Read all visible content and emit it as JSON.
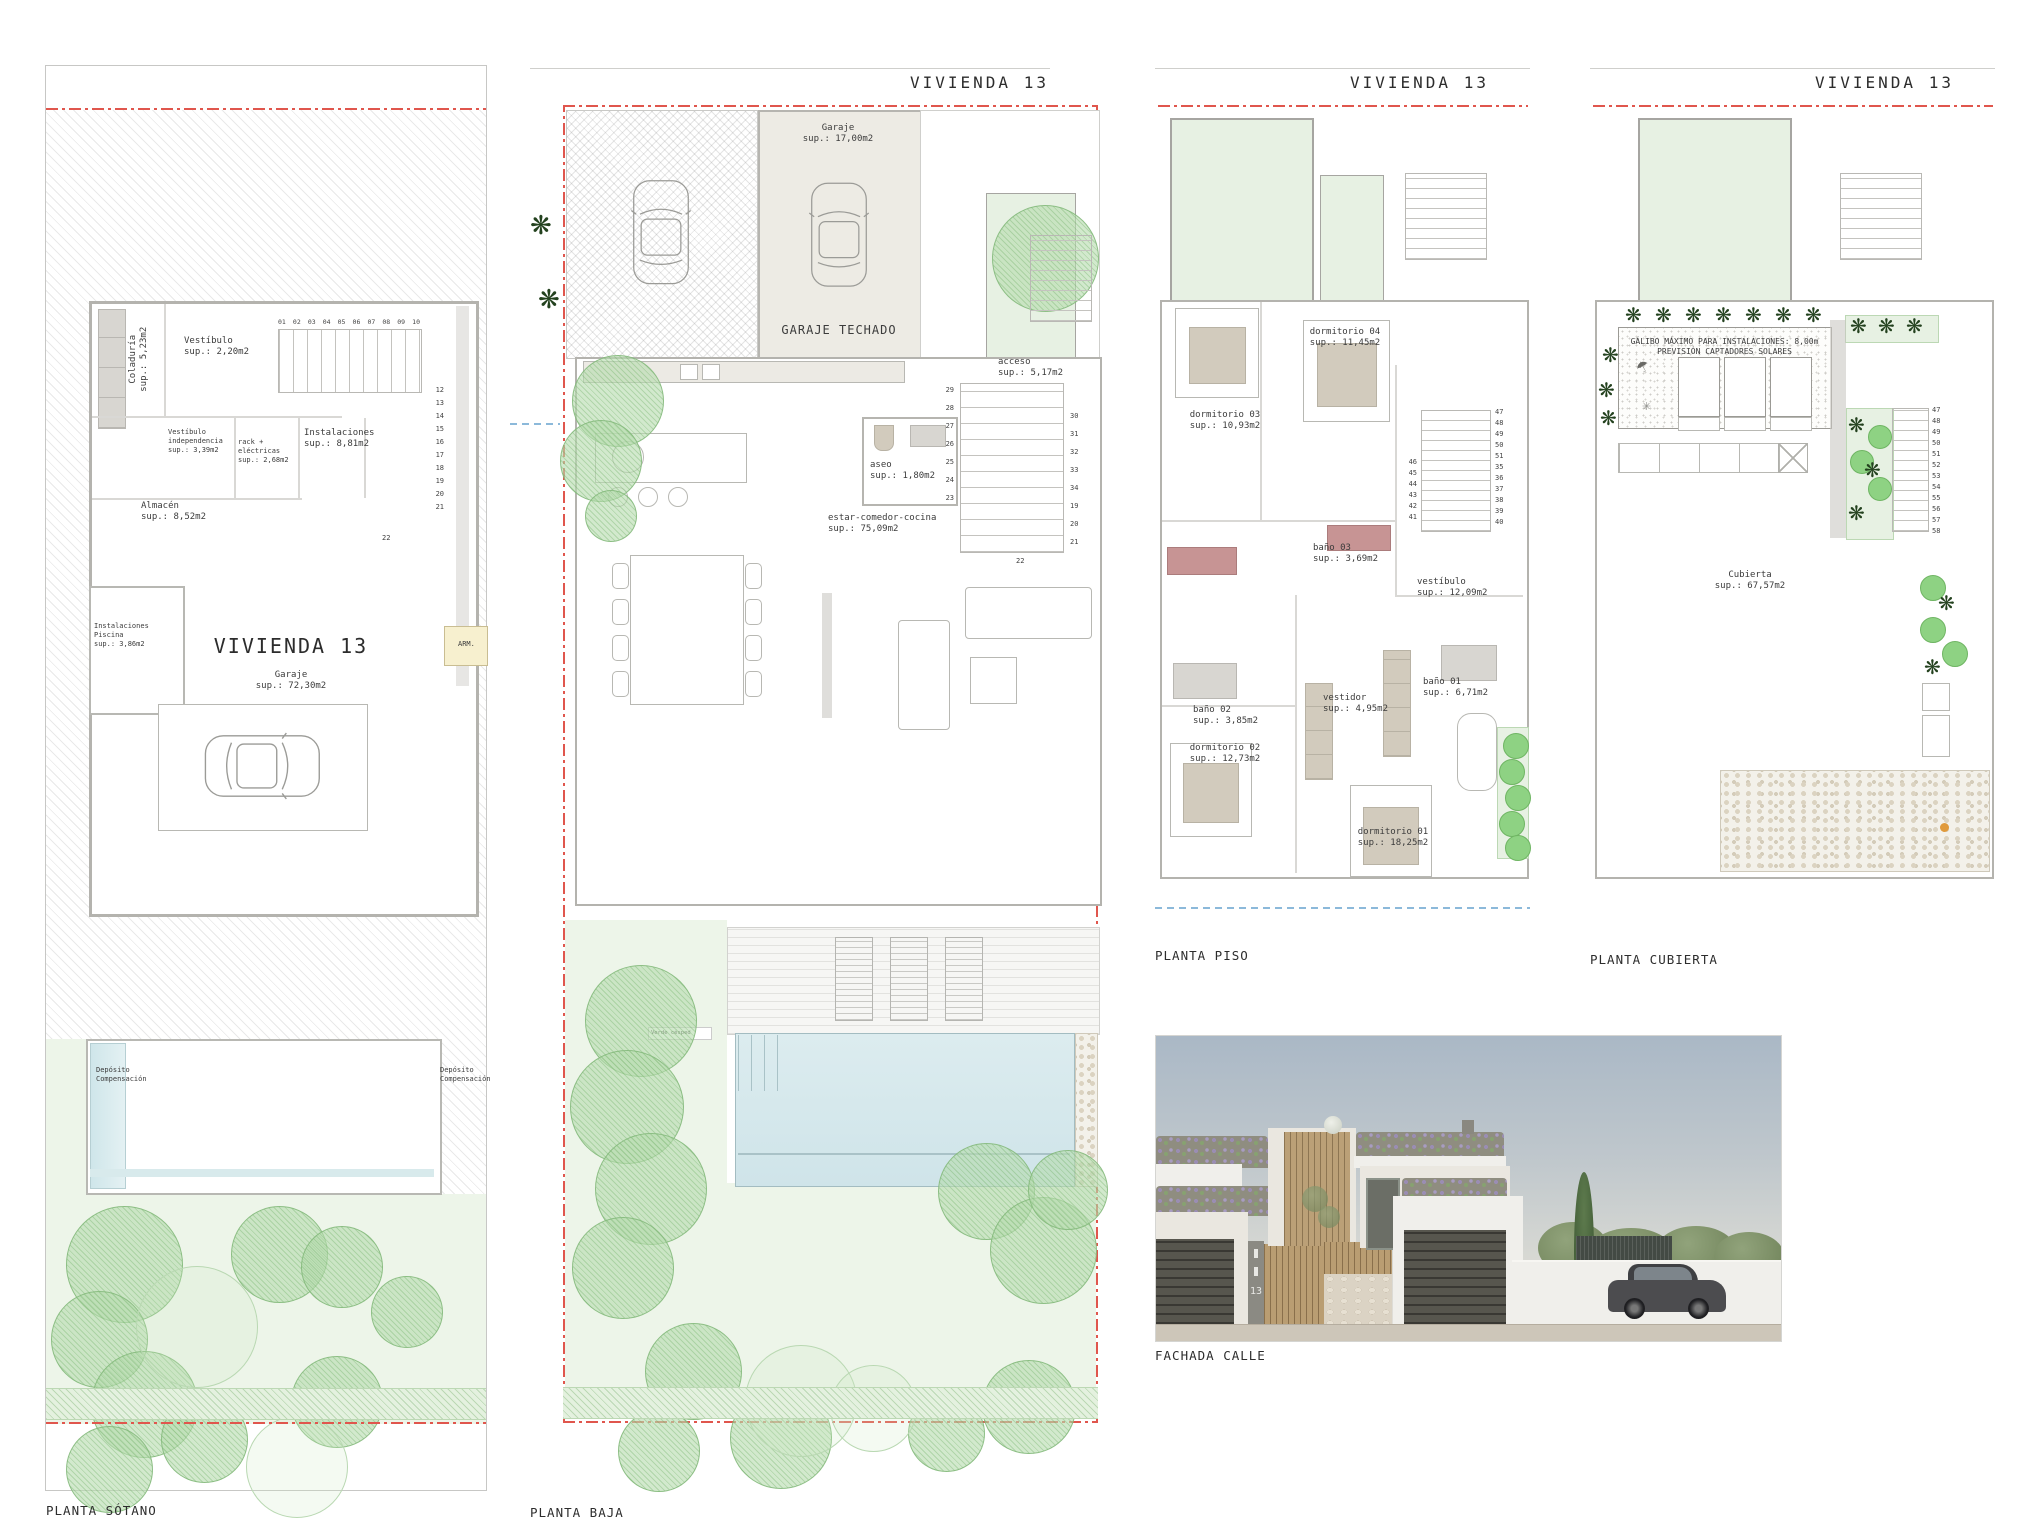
{
  "header": {
    "vivienda": "VIVIENDA 13"
  },
  "captions": {
    "sotano": "PLANTA SÓTANO",
    "baja": "PLANTA BAJA",
    "piso": "PLANTA PISO",
    "cubierta": "PLANTA CUBIERTA",
    "fachada": "FACHADA CALLE"
  },
  "sotano": {
    "coladuria": "Coladuría\nsup.: 5,23m2",
    "vestibulo": "Vestíbulo\nsup.: 2,20m2",
    "vestibulo_indep": "Vestíbulo\nindependencia\nsup.: 3,39m2",
    "rack": "rack + eléctricas\nsup.: 2,68m2",
    "instalaciones": "Instalaciones\nsup.: 8,81m2",
    "almacen": "Almacén\nsup.: 8,52m2",
    "inst_piscina": "Instalaciones Piscina\nsup.: 3,86m2",
    "vivienda": "VIVIENDA 13",
    "garaje": "Garaje\nsup.: 72,30m2",
    "armario": "ARM.",
    "deposito_izq": "Depósito\nCompensación",
    "deposito_der": "Depósito\nCompensación",
    "stairs_top": [
      "01",
      "02",
      "03",
      "04",
      "05",
      "06",
      "07",
      "08",
      "09",
      "10"
    ],
    "stairs_side": [
      "12",
      "13",
      "14",
      "15",
      "16",
      "17",
      "18",
      "19",
      "20",
      "21"
    ],
    "stair_22": "22"
  },
  "baja": {
    "garaje": "Garaje\nsup.: 17,00m2",
    "garaje_techado": "GARAJE TECHADO",
    "acceso": "acceso\nsup.: 5,17m2",
    "aseo": "aseo\nsup.: 1,80m2",
    "estar": "estar-comedor-cocina\nsup.: 75,09m2",
    "verde": "Verde césped",
    "stairs_left": [
      "29",
      "28",
      "27",
      "26",
      "25",
      "24",
      "23"
    ],
    "stairs_right": [
      "30",
      "31",
      "32",
      "33",
      "34",
      "19",
      "20",
      "21"
    ],
    "stair_22": "22"
  },
  "piso": {
    "dormitorio03": "dormitorio 03\nsup.: 10,93m2",
    "dormitorio04": "dormitorio 04\nsup.: 11,45m2",
    "bano02": "baño 02\nsup.: 3,85m2",
    "bano03": "baño 03\nsup.: 3,69m2",
    "vestibulo": "vestíbulo\nsup.: 12,09m2",
    "dormitorio02": "dormitorio 02\nsup.: 12,73m2",
    "vestidor": "vestidor\nsup.: 4,95m2",
    "bano01": "baño 01\nsup.: 6,71m2",
    "dormitorio01": "dormitorio 01\nsup.: 18,25m2",
    "stairs_left": [
      "46",
      "45",
      "44",
      "43",
      "42",
      "41"
    ],
    "stairs_right": [
      "47",
      "48",
      "49",
      "50",
      "51",
      "35",
      "36",
      "37",
      "38",
      "39",
      "40"
    ]
  },
  "cubierta": {
    "galibo": "GÁLIBO MÁXIMO PARA INSTALACIONES: 8,00m\nPREVISIÓN CAPTADORES SOLARES",
    "cubierta": "Cubierta\nsup.: 67,57m2",
    "stairs": [
      "47",
      "48",
      "49",
      "50",
      "51",
      "52",
      "53",
      "54",
      "55",
      "56",
      "57",
      "58"
    ]
  },
  "fachada": {
    "numero": "13"
  },
  "colors": {
    "boundary_red": "#e0564d",
    "service_blue": "#8cb9da",
    "tree_green": "#9cc795",
    "lawn_green": "#edf5e9",
    "pool_blue": "#cfe4e9",
    "wall_gray": "#b4b3ae",
    "wood": "#b99d72",
    "garage_door": "#57564e",
    "armario_yellow": "#f7f0cf"
  }
}
